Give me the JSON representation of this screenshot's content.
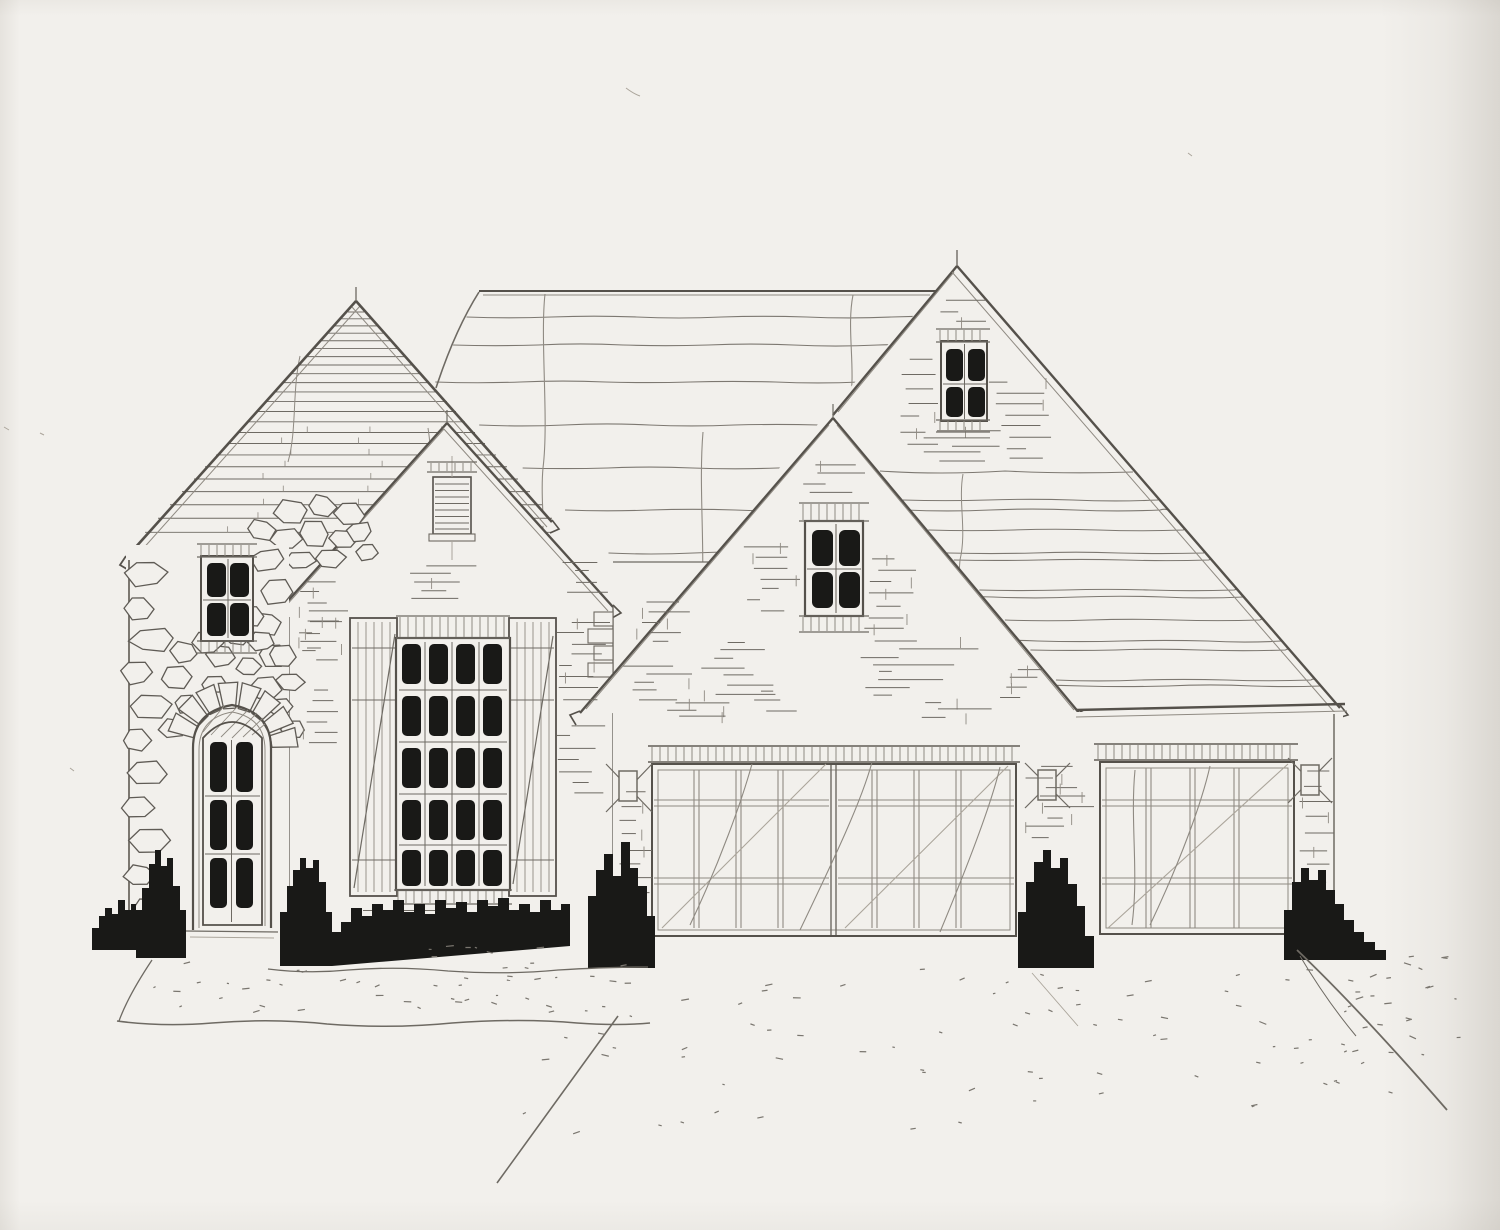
{
  "aria": {
    "label": "Hand-drawn architectural front elevation sketch of a one-story house with stone entry tower, three gables, a double garage and a single garage, pencil and ink on paper"
  },
  "document": {
    "type": "architectural-elevation-sketch",
    "medium": "pencil and black ink on paper",
    "view": "front elevation",
    "description": "Front elevation rendering: stone entry tower with arched door, gabled wing with shuttered multi-pane window, large shingled main roof, two brick gables with small four-pane windows, double and single garage doors, foundation shrubs and stippled driveway"
  },
  "palette": {
    "paper": "#f2f0ec",
    "pencil_dark": "#55514b",
    "pencil": "#6e6a63",
    "pencil_light": "#8f8a82",
    "pencil_xlight": "#aba59b",
    "ink": "#191917"
  },
  "elements": {
    "roofs": [
      "main-roof",
      "tower-gable-roof",
      "pent-roof-over-single-garage"
    ],
    "gables": [
      "tower-gable",
      "middle-gable",
      "center-gable",
      "right-gable"
    ],
    "windows": [
      {
        "name": "tower-window",
        "panes": "2x2"
      },
      {
        "name": "feature-window",
        "panes": "4x5",
        "shutters": 2
      },
      {
        "name": "attic-vent",
        "type": "louvered"
      },
      {
        "name": "center-gable-window",
        "panes": "2x2"
      },
      {
        "name": "right-gable-window",
        "panes": "2x2"
      }
    ],
    "doors": [
      {
        "name": "entry-door",
        "lites": "2x3",
        "surround": "stone-arch"
      },
      {
        "name": "double-garage-door",
        "leaves": 2
      },
      {
        "name": "single-garage-door",
        "leaves": 1
      }
    ],
    "lighting": {
      "wall_sconces": 3
    },
    "landscape": {
      "bushes": 7,
      "hedge_rows": 1,
      "driveway": true,
      "stone_walk": true
    }
  }
}
